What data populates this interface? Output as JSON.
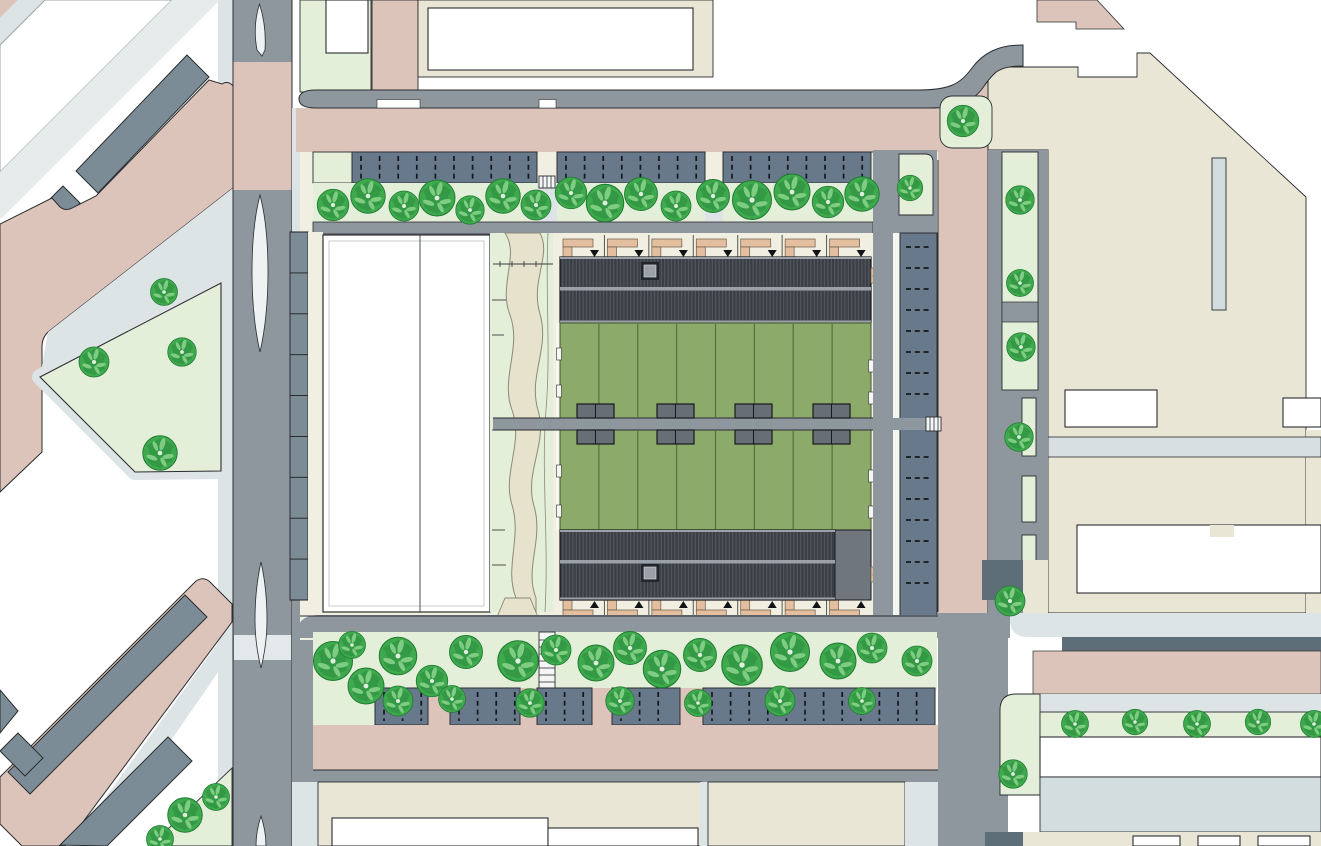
{
  "colors": {
    "road_gray": "#8e979e",
    "road_dark": "#5e6e79",
    "sidewalk": "#dde4e6",
    "sidewalk_light": "#e6ebec",
    "pink": "#ddc4bb",
    "beige": "#eae6d6",
    "cream": "#f1efe1",
    "light_green": "#e4efda",
    "lawn_green": "#8cab6b",
    "lawn_line": "#55703f",
    "building_slate": "#7b8c96",
    "parking_slate": "#67798a",
    "roof_dark": "#3a3e45",
    "roof_stripe": "#565c64",
    "roof_ridge": "#9aa1a8",
    "shed_gray": "#686e75",
    "flat_roof": "#70767e",
    "tree_green": "#3fa94e",
    "tree_dark": "#2d9040",
    "tree_light": "#7ecd82",
    "entry_tan": "#e3bf9f",
    "strip_blue": "#d3dcdf",
    "outline": "#2b2e31"
  },
  "map": {
    "courtyard": {
      "units_per_row": 7,
      "row_width": 311,
      "row_left_x": 560,
      "garden_columns": 8,
      "shed_pairs_x": [
        577,
        657,
        735,
        813
      ]
    },
    "left_strip_segments": 9,
    "top_parking_segments": [
      [
        352,
        537
      ],
      [
        557,
        705
      ],
      [
        723,
        871
      ]
    ],
    "bottom_parking_segments": [
      [
        375,
        428
      ],
      [
        450,
        520
      ],
      [
        537,
        592
      ],
      [
        612,
        680
      ],
      [
        703,
        935
      ]
    ],
    "right_parking": {
      "y_start": 247,
      "y_end": 600,
      "step": 21,
      "gap_top": 410,
      "gap_bottom": 438
    },
    "trees": [
      [
        333,
        205,
        1.05
      ],
      [
        368,
        196,
        1.15
      ],
      [
        404,
        206,
        1.0
      ],
      [
        437,
        198,
        1.2
      ],
      [
        470,
        210,
        0.95
      ],
      [
        503,
        196,
        1.15
      ],
      [
        536,
        205,
        1.0
      ],
      [
        571,
        193,
        1.05
      ],
      [
        605,
        203,
        1.25
      ],
      [
        641,
        194,
        1.1
      ],
      [
        676,
        206,
        1.0
      ],
      [
        713,
        196,
        1.1
      ],
      [
        752,
        200,
        1.3
      ],
      [
        792,
        192,
        1.2
      ],
      [
        828,
        202,
        1.05
      ],
      [
        862,
        194,
        1.15
      ],
      [
        910,
        188,
        0.85
      ],
      [
        963,
        121,
        1.05
      ],
      [
        1020,
        200,
        0.95
      ],
      [
        1020,
        283,
        0.9
      ],
      [
        1021,
        347,
        0.95
      ],
      [
        1019,
        437,
        0.95
      ],
      [
        1010,
        601,
        1.0
      ],
      [
        1013,
        774,
        0.95
      ],
      [
        94,
        362,
        1.0
      ],
      [
        182,
        352,
        0.95
      ],
      [
        160,
        453,
        1.15
      ],
      [
        164,
        292,
        0.9
      ],
      [
        185,
        815,
        1.15
      ],
      [
        216,
        797,
        0.9
      ],
      [
        160,
        839,
        0.9
      ],
      [
        333,
        661,
        1.3
      ],
      [
        352,
        645,
        0.9
      ],
      [
        366,
        686,
        1.2
      ],
      [
        398,
        656,
        1.25
      ],
      [
        432,
        681,
        1.05
      ],
      [
        466,
        652,
        1.1
      ],
      [
        518,
        661,
        1.35
      ],
      [
        556,
        650,
        1.0
      ],
      [
        596,
        663,
        1.2
      ],
      [
        630,
        648,
        1.1
      ],
      [
        662,
        669,
        1.25
      ],
      [
        700,
        655,
        1.1
      ],
      [
        742,
        665,
        1.35
      ],
      [
        790,
        652,
        1.3
      ],
      [
        838,
        661,
        1.2
      ],
      [
        872,
        648,
        1.0
      ],
      [
        917,
        661,
        1.0
      ],
      [
        398,
        701,
        1.0
      ],
      [
        452,
        699,
        0.9
      ],
      [
        530,
        703,
        0.95
      ],
      [
        620,
        701,
        0.95
      ],
      [
        698,
        703,
        0.9
      ],
      [
        780,
        701,
        1.0
      ],
      [
        862,
        701,
        0.9
      ],
      [
        1075,
        724,
        0.9
      ],
      [
        1135,
        722,
        0.85
      ],
      [
        1197,
        724,
        0.9
      ],
      [
        1258,
        722,
        0.85
      ],
      [
        1314,
        724,
        0.9
      ]
    ]
  }
}
